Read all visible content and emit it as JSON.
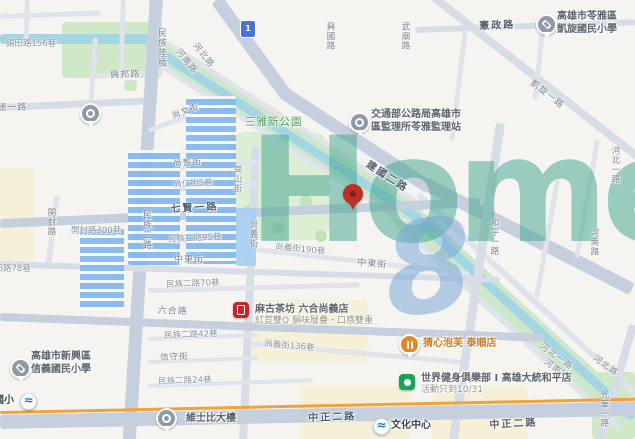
{
  "watermark": {
    "word": "Home",
    "digit": "8"
  },
  "highway_shield": "1",
  "map": {
    "streets": [
      {
        "t": "錦田路156巷",
        "x": 6,
        "y": 37,
        "r": 0,
        "c": "lane"
      },
      {
        "t": "興邦路",
        "x": 110,
        "y": 68,
        "r": -3,
        "c": "st"
      },
      {
        "t": "八德一路",
        "x": -13,
        "y": 101,
        "r": -2,
        "c": "st"
      },
      {
        "t": "民族陸橋",
        "x": 155,
        "y": 28,
        "r": "v",
        "c": "st"
      },
      {
        "t": "河南路",
        "x": 183,
        "y": 46,
        "r": 52,
        "c": "st-s"
      },
      {
        "t": "河北路",
        "x": 200,
        "y": 40,
        "r": 52,
        "c": "st-s"
      },
      {
        "t": "興國路",
        "x": 324,
        "y": 22,
        "r": "v",
        "c": "st-s"
      },
      {
        "t": "武廟路",
        "x": 399,
        "y": 22,
        "r": "v",
        "c": "st-s"
      },
      {
        "t": "憲政路",
        "x": 479,
        "y": 17,
        "r": -2,
        "c": "st-b"
      },
      {
        "t": "凱旋一路",
        "x": 536,
        "y": 76,
        "r": 38,
        "c": "st"
      },
      {
        "t": "三雅新公園",
        "x": 245,
        "y": 114,
        "r": 0,
        "c": "park-t"
      },
      {
        "t": "建國二路",
        "x": 372,
        "y": 156,
        "r": 33,
        "c": "st-b"
      },
      {
        "t": "尚文街",
        "x": 170,
        "y": 110,
        "r": -20,
        "c": "st-s"
      },
      {
        "t": "尚智街",
        "x": 173,
        "y": 157,
        "r": -3,
        "c": "st-s"
      },
      {
        "t": "尚仁街5巷",
        "x": 173,
        "y": 178,
        "r": -3,
        "c": "lane"
      },
      {
        "t": "七賢一路",
        "x": 170,
        "y": 200,
        "r": -3,
        "c": "st-b"
      },
      {
        "t": "崗山街",
        "x": 231,
        "y": 165,
        "r": "v",
        "c": "st-s"
      },
      {
        "t": "尚義街",
        "x": 247,
        "y": 220,
        "r": "v",
        "c": "st-s"
      },
      {
        "t": "民族二路",
        "x": 140,
        "y": 210,
        "r": "v",
        "c": "st"
      },
      {
        "t": "民族二路95巷",
        "x": 168,
        "y": 233,
        "r": -3,
        "c": "lane"
      },
      {
        "t": "中東街",
        "x": 174,
        "y": 252,
        "r": 0,
        "c": "st"
      },
      {
        "t": "尚義街190巷",
        "x": 276,
        "y": 240,
        "r": 6,
        "c": "lane"
      },
      {
        "t": "中東街",
        "x": 358,
        "y": 255,
        "r": 5,
        "c": "st"
      },
      {
        "t": "開封路",
        "x": 45,
        "y": 208,
        "r": "v",
        "c": "st-s"
      },
      {
        "t": "開封路300巷",
        "x": 71,
        "y": 224,
        "r": 0,
        "c": "lane"
      },
      {
        "t": "錦田路78巷",
        "x": -14,
        "y": 262,
        "r": 0,
        "c": "lane"
      },
      {
        "t": "民族二路70巷",
        "x": 166,
        "y": 278,
        "r": -2,
        "c": "lane"
      },
      {
        "t": "六合路",
        "x": 158,
        "y": 303,
        "r": 2,
        "c": "st"
      },
      {
        "t": "民族二路42巷",
        "x": 164,
        "y": 329,
        "r": -2,
        "c": "lane"
      },
      {
        "t": "尚義街136巷",
        "x": 265,
        "y": 337,
        "r": 5,
        "c": "lane"
      },
      {
        "t": "信守街",
        "x": 160,
        "y": 351,
        "r": -2,
        "c": "st-s"
      },
      {
        "t": "民族二路24巷",
        "x": 158,
        "y": 375,
        "r": -2,
        "c": "lane"
      },
      {
        "t": "中正二路",
        "x": 308,
        "y": 409,
        "r": -2,
        "c": "st-b"
      },
      {
        "t": "中正二路",
        "x": 489,
        "y": 416,
        "r": -3,
        "c": "st-b"
      },
      {
        "t": "河北一路",
        "x": 545,
        "y": 340,
        "r": 36,
        "c": "st-s"
      },
      {
        "t": "河南路",
        "x": 549,
        "y": 356,
        "r": 36,
        "c": "st-s"
      },
      {
        "t": "河北路",
        "x": 598,
        "y": 352,
        "r": 36,
        "c": "st-s"
      },
      {
        "t": "和平一路",
        "x": 488,
        "y": 218,
        "r": "v",
        "c": "st-s"
      },
      {
        "t": "河北一路",
        "x": 609,
        "y": 146,
        "r": "v",
        "c": "st-s"
      },
      {
        "t": "河南路",
        "x": 588,
        "y": 228,
        "r": "v",
        "c": "st-s"
      },
      {
        "t": "光華一路",
        "x": 598,
        "y": 390,
        "r": "v",
        "c": "st-s"
      }
    ],
    "pois": [
      {
        "icon": "place-pin-icon",
        "kind": "pin",
        "x": 80,
        "y": 103
      },
      {
        "icon": "school-icon",
        "kind": "pin",
        "x": 536,
        "y": 14,
        "name": "高雄市苓雅區",
        "name2": "凱旋國民小學",
        "tx": 557,
        "ty": 10
      },
      {
        "icon": "government-icon",
        "kind": "pin",
        "x": 349,
        "y": 112,
        "name": "交通部公路局高雄市",
        "name2": "區監理所苓雅監理站",
        "tx": 371,
        "ty": 108
      },
      {
        "icon": "school-icon",
        "kind": "pin",
        "x": 10,
        "y": 358,
        "name": "高雄市新興區",
        "name2": "信義國民小學",
        "tx": 31,
        "ty": 350
      },
      {
        "icon": "bubble-tea-logo-icon",
        "kind": "red-sq",
        "x": 233,
        "y": 302,
        "name": "麻古茶坊 六合尚義店",
        "sub": "紅荳雙Q 韻味層疊・口感雙重",
        "tx": 255,
        "ty": 303
      },
      {
        "icon": "restaurant-icon",
        "kind": "orange-pin",
        "x": 399,
        "y": 334,
        "name": "猜心泡芙 泰順店",
        "tx": 423,
        "ty": 337,
        "cls": "food"
      },
      {
        "icon": "gym-logo-icon",
        "kind": "green-sq",
        "x": 399,
        "y": 374,
        "name": "世界健身俱樂部 I 高雄大統和平店",
        "sub": "活動只到10/31",
        "tx": 421,
        "ty": 372
      },
      {
        "icon": "building-pin-icon",
        "kind": "pin",
        "x": 156,
        "y": 408,
        "name": "維士比大樓",
        "tx": 186,
        "ty": 412
      },
      {
        "icon": "metro-icon",
        "kind": "mrt",
        "x": 20,
        "y": 393,
        "name": "信義國小",
        "tx": -26,
        "ty": 394,
        "cls": "mrtlab"
      },
      {
        "icon": "metro-icon",
        "kind": "mrt",
        "x": 373,
        "y": 418,
        "name": "文化中心",
        "tx": 391,
        "ty": 419,
        "cls": "mrtlab"
      }
    ]
  }
}
